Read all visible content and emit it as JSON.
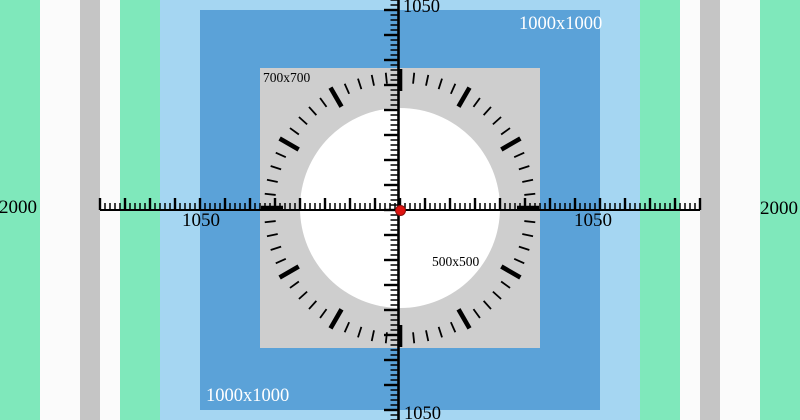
{
  "title": "size calibration test pattern",
  "palette": {
    "green": "#7fe8bb",
    "white_stripe": "#fbfbfb",
    "gray_stripe": "#c5c5c5",
    "light_blue": "#a5d6f2",
    "dark_blue": "#5ba2d8",
    "gray_square": "#cecece",
    "circle_white": "#ffffff",
    "ink": "#000000",
    "label_light": "#ffffff",
    "dot_red": "#df1310",
    "dot_red_dark": "#8a0f0c"
  },
  "labels": {
    "axis_top": "1050",
    "axis_bottom": "1050",
    "axis_left": "1050",
    "axis_right": "1050",
    "edge_left": "2000",
    "edge_right": "2000",
    "blue_square_tr": "1000x1000",
    "blue_square_bl": "1000x1000",
    "gray_square": "700x700",
    "white_circle": "500x500"
  }
}
